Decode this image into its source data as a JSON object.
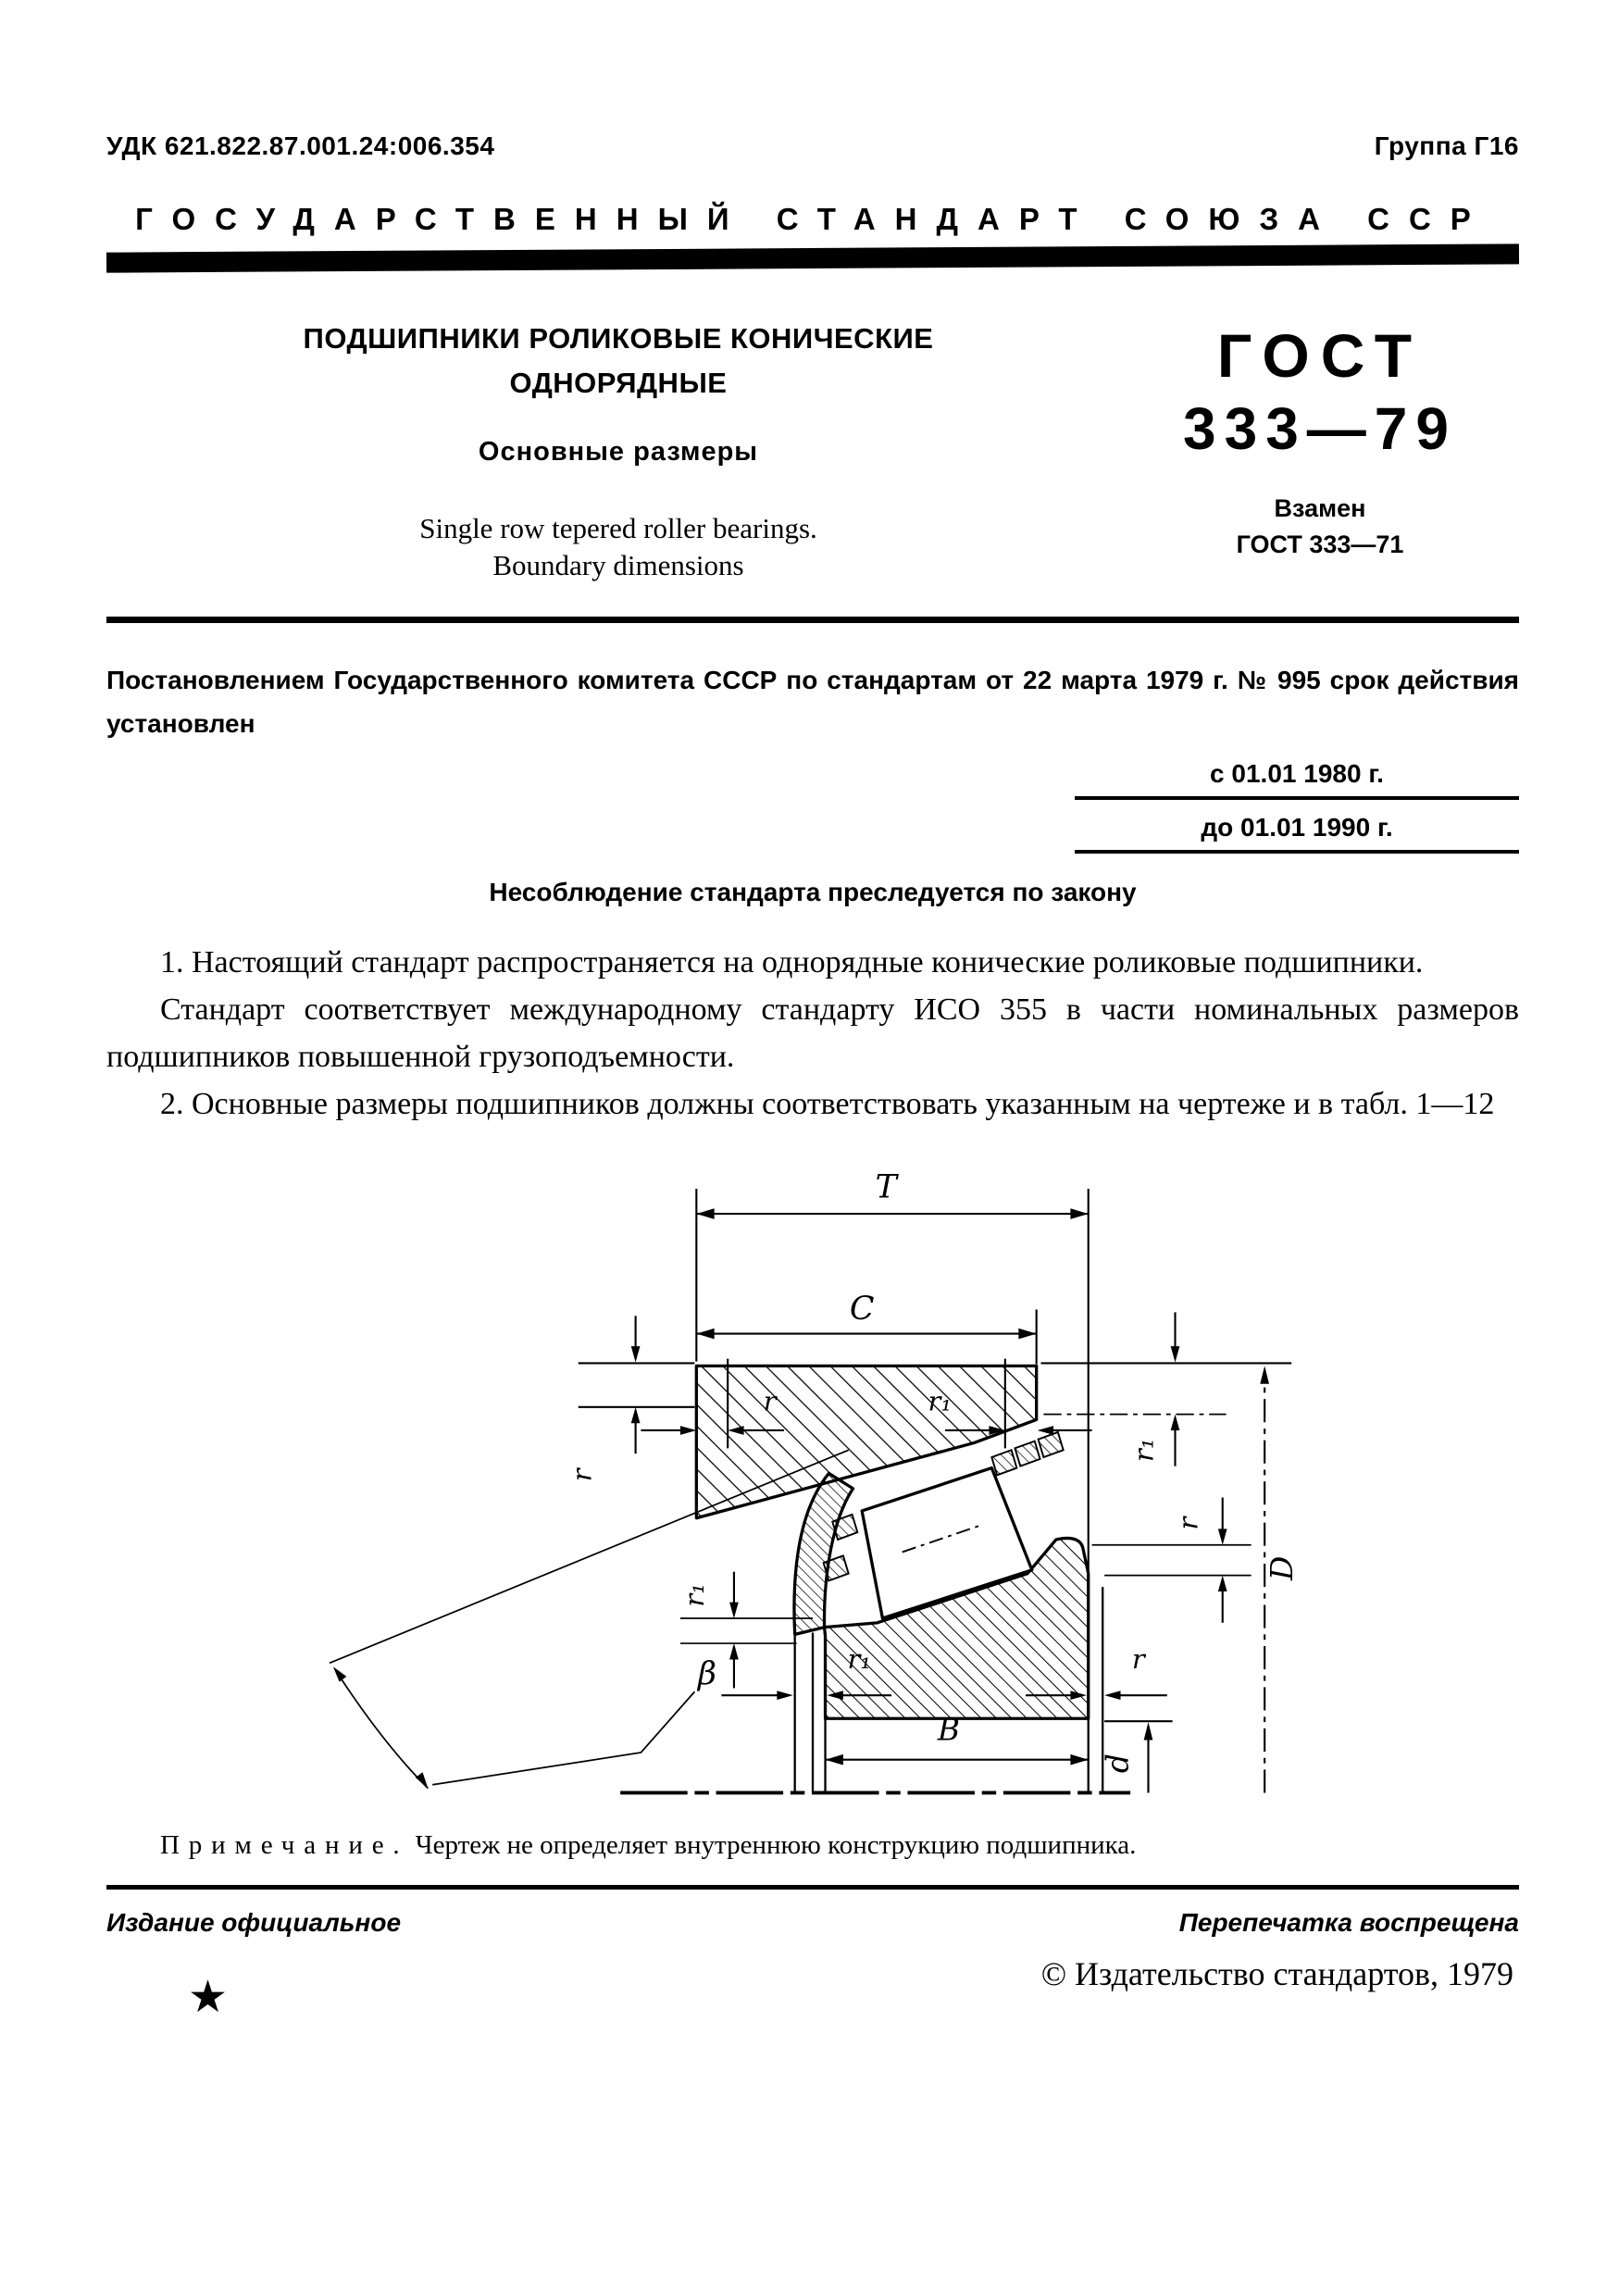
{
  "document": {
    "udk": "УДК 621.822.87.001.24:006.354",
    "group": "Группа Г16",
    "header": "ГОСУДАРСТВЕННЫЙ СТАНДАРТ СОЮЗА ССР",
    "title": {
      "ru_line1": "ПОДШИПНИКИ РОЛИКОВЫЕ КОНИЧЕСКИЕ",
      "ru_line2": "ОДНОРЯДНЫЕ",
      "subtitle_ru": "Основные размеры",
      "en_line1": "Single row tepered roller bearings.",
      "en_line2": "Boundary dimensions"
    },
    "designation": {
      "gost": "ГОСТ",
      "number": "333—79",
      "replaces_label": "Взамен",
      "replaces": "ГОСТ 333—71"
    },
    "decree": "Постановлением Государственного комитета СССР по стандартам от 22 марта 1979 г. № 995 срок действия установлен",
    "valid_from": "с 01.01 1980 г.",
    "valid_to": "до 01.01 1990 г.",
    "law_notice": "Несоблюдение стандарта преследуется по закону",
    "paragraphs": {
      "p1": "1. Настоящий стандарт распространяется на однорядные конические роликовые подшипники.",
      "p2": "Стандарт соответствует международному стандарту ИСО 355 в части номинальных размеров подшипников повышенной грузоподъемности.",
      "p3": "2. Основные размеры подшипников должны соответствовать указанным на чертеже и в табл. 1—12"
    },
    "note": {
      "label": "Примечание.",
      "text": "Чертеж не определяет внутреннюю конструкцию подшипника."
    },
    "footer": {
      "edition": "Издание официальное",
      "reprint": "Перепечатка воспрещена",
      "star": "★",
      "copyright": "© Издательство стандартов, 1979"
    }
  },
  "drawing": {
    "description": "Cross-section of a single row tapered roller bearing with boundary dimensions",
    "labels": {
      "T": "T",
      "C": "C",
      "r": "r",
      "r1": "r₁",
      "beta": "β",
      "B": "B",
      "D": "D",
      "d": "d"
    }
  }
}
